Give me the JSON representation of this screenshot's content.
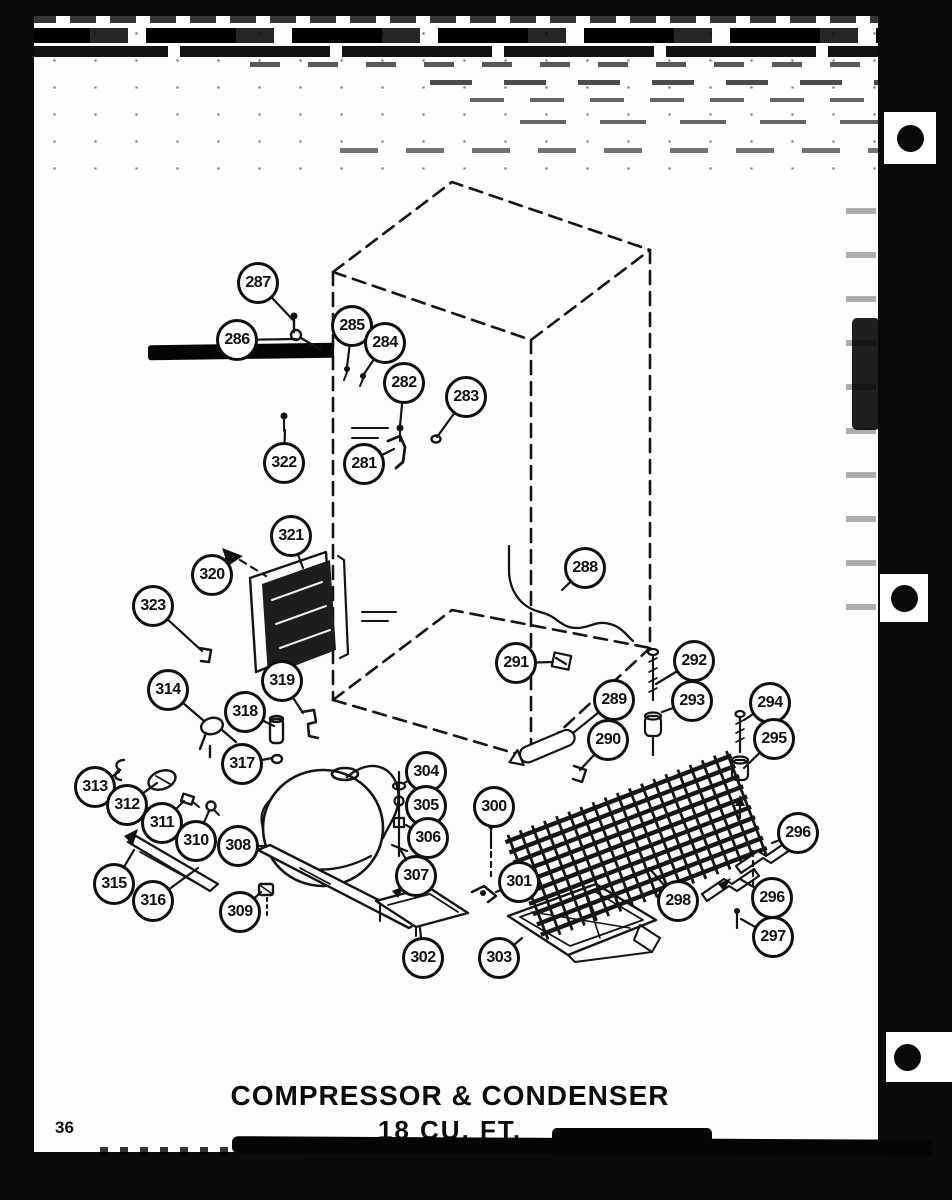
{
  "footer": {
    "title_line1": "COMPRESSOR & CONDENSER",
    "title_line2": "18 CU. FT.",
    "page_number": "36"
  },
  "diagram": {
    "subject": "Exploded parts view of refrigerator compressor and condenser assembly",
    "callouts": [
      {
        "label": "287"
      },
      {
        "label": "286"
      },
      {
        "label": "285"
      },
      {
        "label": "284"
      },
      {
        "label": "282"
      },
      {
        "label": "283"
      },
      {
        "label": "322"
      },
      {
        "label": "281"
      },
      {
        "label": "321"
      },
      {
        "label": "320"
      },
      {
        "label": "323"
      },
      {
        "label": "314"
      },
      {
        "label": "319"
      },
      {
        "label": "318"
      },
      {
        "label": "317"
      },
      {
        "label": "313"
      },
      {
        "label": "312"
      },
      {
        "label": "311"
      },
      {
        "label": "310"
      },
      {
        "label": "315"
      },
      {
        "label": "316"
      },
      {
        "label": "308"
      },
      {
        "label": "309"
      },
      {
        "label": "304"
      },
      {
        "label": "305"
      },
      {
        "label": "306"
      },
      {
        "label": "307"
      },
      {
        "label": "300"
      },
      {
        "label": "301"
      },
      {
        "label": "302"
      },
      {
        "label": "303"
      },
      {
        "label": "288"
      },
      {
        "label": "291"
      },
      {
        "label": "289"
      },
      {
        "label": "290"
      },
      {
        "label": "292"
      },
      {
        "label": "293"
      },
      {
        "label": "294"
      },
      {
        "label": "295"
      },
      {
        "label": "296"
      },
      {
        "label": "296"
      },
      {
        "label": "297"
      },
      {
        "label": "298"
      }
    ]
  },
  "colors": {
    "ink": "#111111",
    "paper": "#fdfdfc"
  }
}
